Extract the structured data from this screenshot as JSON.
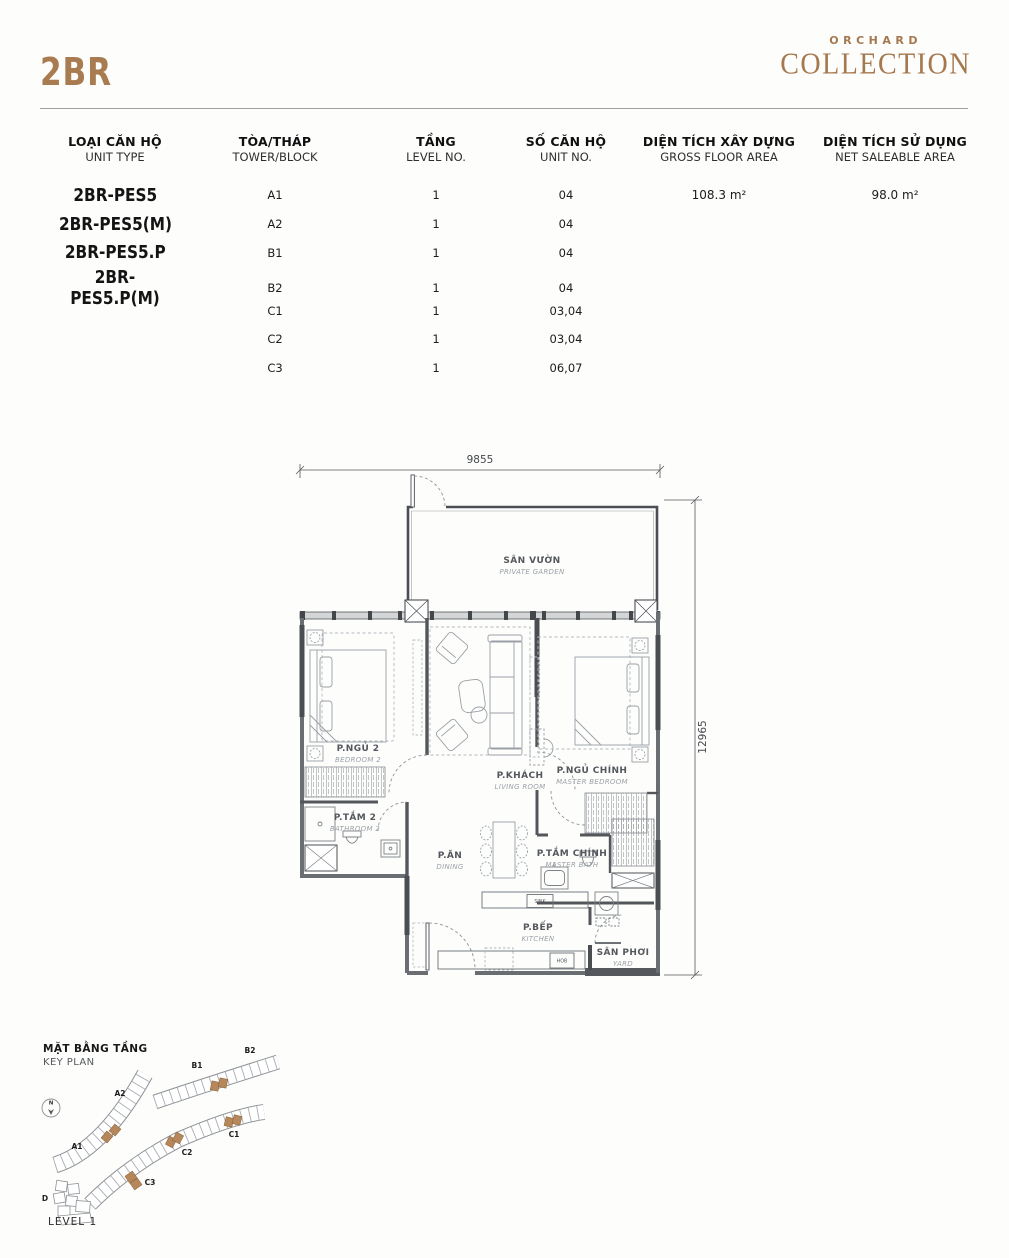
{
  "header": {
    "title": "2BR",
    "brand_line1": "ORCHARD",
    "brand_line2": "COLLECTION"
  },
  "table": {
    "columns": [
      {
        "vi": "LOẠI CĂN HỘ",
        "en": "UNIT TYPE"
      },
      {
        "vi": "TÒA/THÁP",
        "en": "TOWER/BLOCK"
      },
      {
        "vi": "TẦNG",
        "en": "LEVEL NO."
      },
      {
        "vi": "SỐ CĂN HỘ",
        "en": "UNIT NO."
      },
      {
        "vi": "DIỆN TÍCH XÂY DỰNG",
        "en": "GROSS FLOOR AREA"
      },
      {
        "vi": "DIỆN TÍCH SỬ DỤNG",
        "en": "NET SALEABLE AREA"
      }
    ],
    "rows": [
      {
        "unit_type": "2BR-PES5",
        "tower": "A1",
        "level": "1",
        "unit_no": "04",
        "gfa": "108.3 m²",
        "nsa": "98.0 m²"
      },
      {
        "unit_type": "2BR-PES5(M)",
        "tower": "A2",
        "level": "1",
        "unit_no": "04",
        "gfa": "",
        "nsa": ""
      },
      {
        "unit_type": "2BR-PES5.P",
        "tower": "B1",
        "level": "1",
        "unit_no": "04",
        "gfa": "",
        "nsa": ""
      },
      {
        "unit_type": "2BR-PES5.P(M)",
        "tower": "B2",
        "level": "1",
        "unit_no": "04",
        "gfa": "",
        "nsa": ""
      },
      {
        "unit_type": "",
        "tower": "C1",
        "level": "1",
        "unit_no": "03,04",
        "gfa": "",
        "nsa": ""
      },
      {
        "unit_type": "",
        "tower": "C2",
        "level": "1",
        "unit_no": "03,04",
        "gfa": "",
        "nsa": ""
      },
      {
        "unit_type": "",
        "tower": "C3",
        "level": "1",
        "unit_no": "06,07",
        "gfa": "",
        "nsa": ""
      }
    ]
  },
  "plan": {
    "dim_width": "9855",
    "dim_height": "12965",
    "rooms": {
      "garden": {
        "vi": "SÂN VƯỜN",
        "en": "PRIVATE GARDEN"
      },
      "bedroom2": {
        "vi": "P.NGỦ 2",
        "en": "BEDROOM 2"
      },
      "living": {
        "vi": "P.KHÁCH",
        "en": "LIVING ROOM"
      },
      "master_bedroom": {
        "vi": "P.NGỦ CHÍNH",
        "en": "MASTER BEDROOM"
      },
      "bathroom2": {
        "vi": "P.TẮM 2",
        "en": "BATHROOM 2"
      },
      "dining": {
        "vi": "P.ĂN",
        "en": "DINING"
      },
      "master_bath": {
        "vi": "P.TẮM CHÍNH",
        "en": "MASTER BATH"
      },
      "kitchen": {
        "vi": "P.BẾP",
        "en": "KITCHEN"
      },
      "yard": {
        "vi": "SÂN PHƠI",
        "en": "YARD"
      }
    },
    "fixtures": {
      "sink": "SINK",
      "hob": "HOB"
    }
  },
  "keyplan": {
    "title_vi": "MẶT BẰNG TẦNG",
    "title_en": "KEY PLAN",
    "level": "LEVEL 1",
    "north": "N",
    "blocks": {
      "a1": "A1",
      "a2": "A2",
      "b1": "B1",
      "b2": "B2",
      "c1": "C1",
      "c2": "C2",
      "c3": "C3",
      "d": "D"
    }
  },
  "colors": {
    "accent": "#A87C50",
    "brand": "#A5784E",
    "highlight": "#B5875A"
  }
}
